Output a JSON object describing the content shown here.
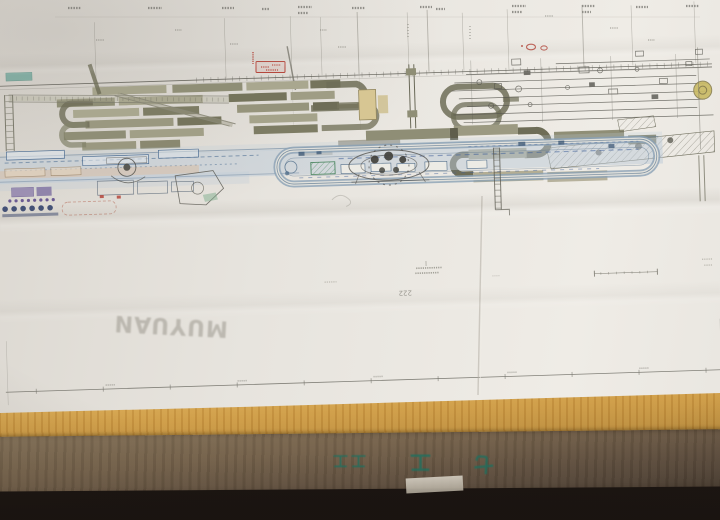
{
  "scene": {
    "kind": "photograph",
    "subject": "Large engineering layout blueprint of a factory conveyor line resting on a cardboard box"
  },
  "paper": {
    "watermark": "MUYUAN",
    "pencil_mark": "222"
  },
  "box": {
    "markings": [
      "工工",
      "工",
      "七"
    ]
  },
  "palette": {
    "paper": "#e7e4de",
    "machine_olive": "#8f8e76",
    "conveyor_blue": "#54708c",
    "stamp_red": "#b5473c",
    "cardboard_top": "#cf9c45",
    "cardboard_front": "#75624b",
    "marking_teal": "#20705f"
  }
}
